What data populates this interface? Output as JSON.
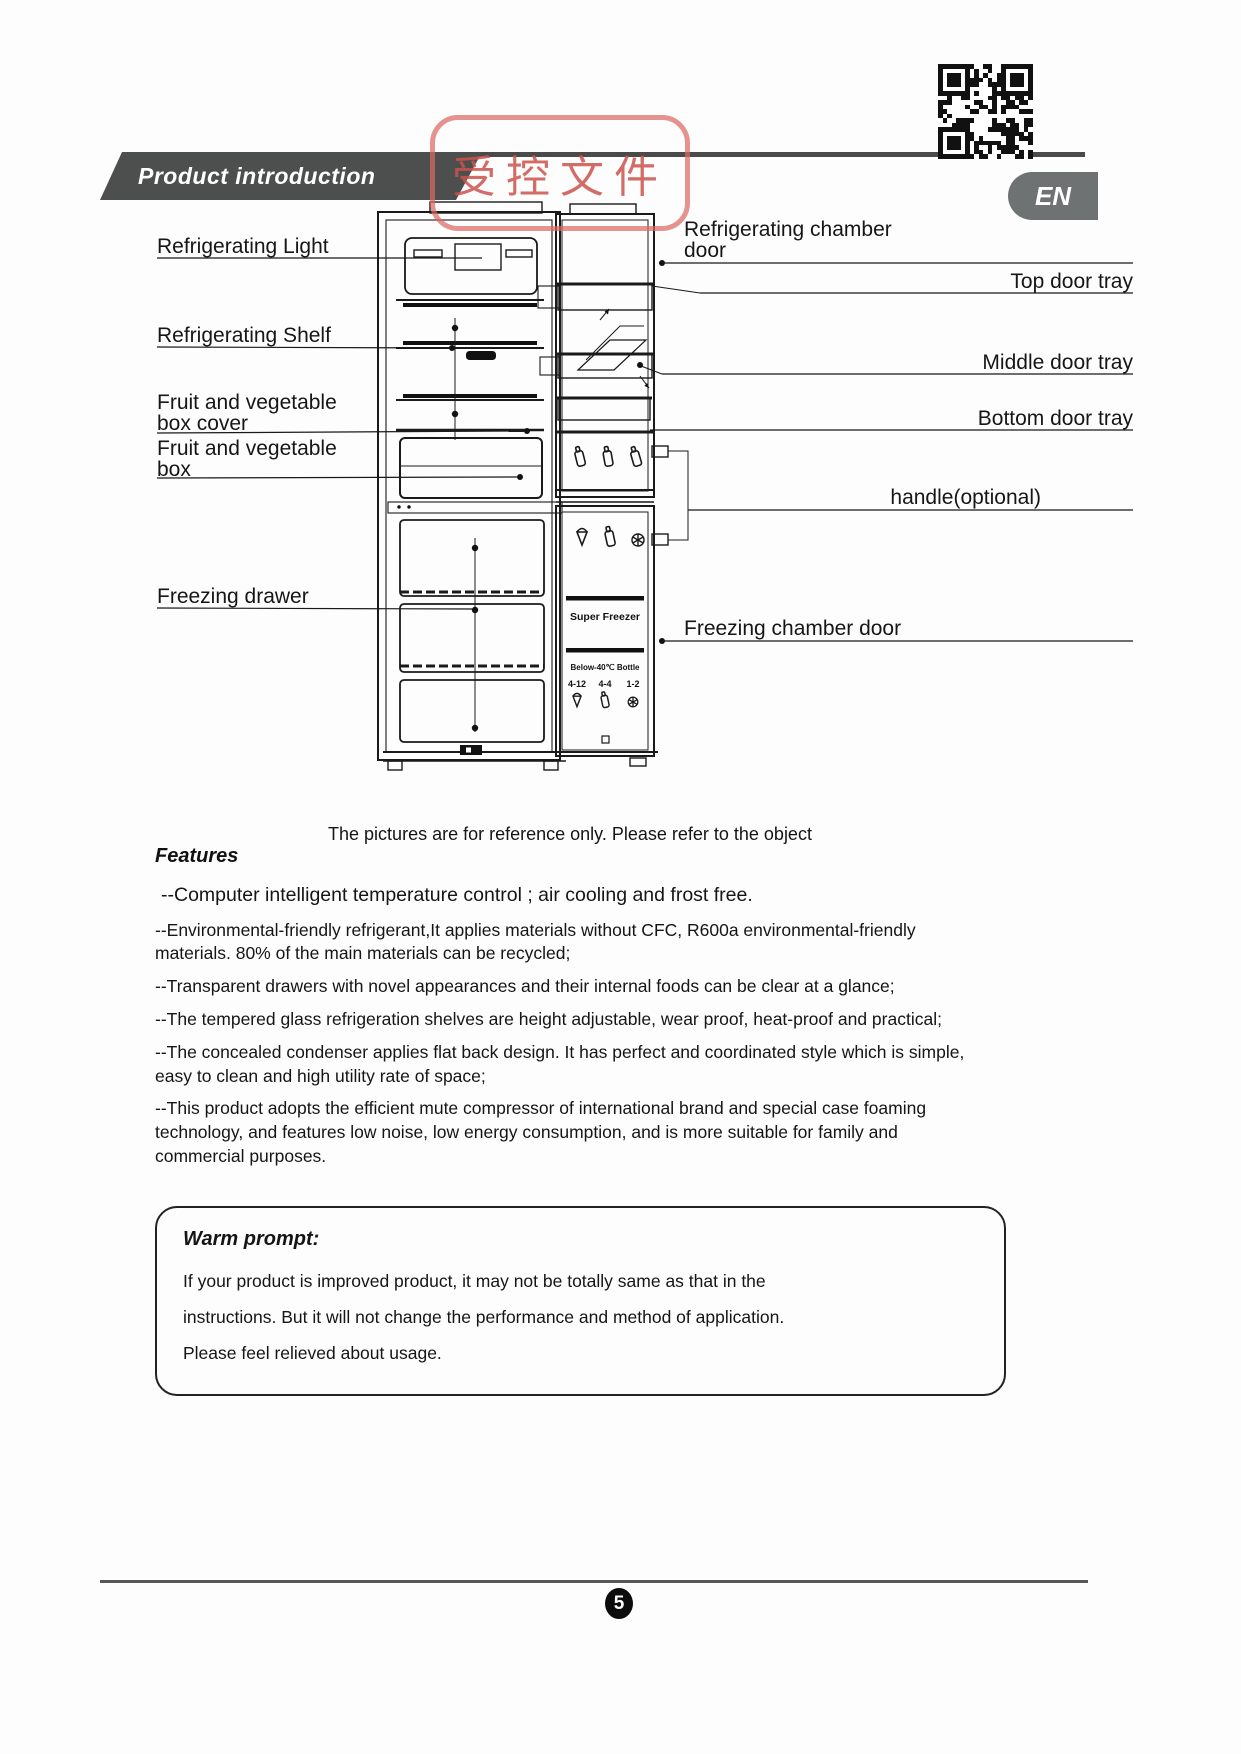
{
  "header": {
    "title": "Product introduction",
    "lang_tab": "EN",
    "stamp": "受控文件"
  },
  "diagram": {
    "labels_left": [
      {
        "text": "Refrigerating Light"
      },
      {
        "text": "Refrigerating Shelf"
      },
      {
        "text": "Fruit and vegetable box cover"
      },
      {
        "text": "Fruit and vegetable box"
      },
      {
        "text": "Freezing drawer"
      }
    ],
    "labels_right": [
      {
        "text": "Refrigerating chamber door"
      },
      {
        "text": "Top door tray"
      },
      {
        "text": "Middle door tray"
      },
      {
        "text": "Bottom door tray"
      },
      {
        "text": "handle(optional)"
      },
      {
        "text": "Freezing chamber door"
      }
    ],
    "door": {
      "super_freezer": "Super Freezer",
      "bottle_note": "Below-40℃ Bottle",
      "temps": [
        "4-12",
        "4-4",
        "1-2"
      ]
    },
    "caption": "The pictures are for reference only. Please refer to the object"
  },
  "features": {
    "heading": "Features",
    "lead": "--Computer intelligent temperature control ; air cooling and frost free.",
    "items": [
      "--Environmental-friendly refrigerant,It applies materials without CFC, R600a environmental-friendly materials. 80% of the main materials can be recycled;",
      "--Transparent drawers with novel appearances and their internal foods can be clear at a glance;",
      "--The tempered glass refrigeration shelves are height adjustable, wear proof, heat-proof and practical;",
      "--The concealed condenser applies flat back design. It has perfect and coordinated style which is simple, easy to clean and high utility rate of space;",
      "--This product adopts the efficient mute compressor of international brand and special case foaming technology, and features low noise, low energy consumption, and is more suitable for family and commercial purposes."
    ]
  },
  "warm_prompt": {
    "title": "Warm prompt:",
    "lines": [
      "If your product is improved product, it may not be totally same as that in the",
      "instructions. But it will not change the performance and method of application.",
      "Please feel relieved about usage."
    ]
  },
  "footer": {
    "page_number": "5"
  }
}
